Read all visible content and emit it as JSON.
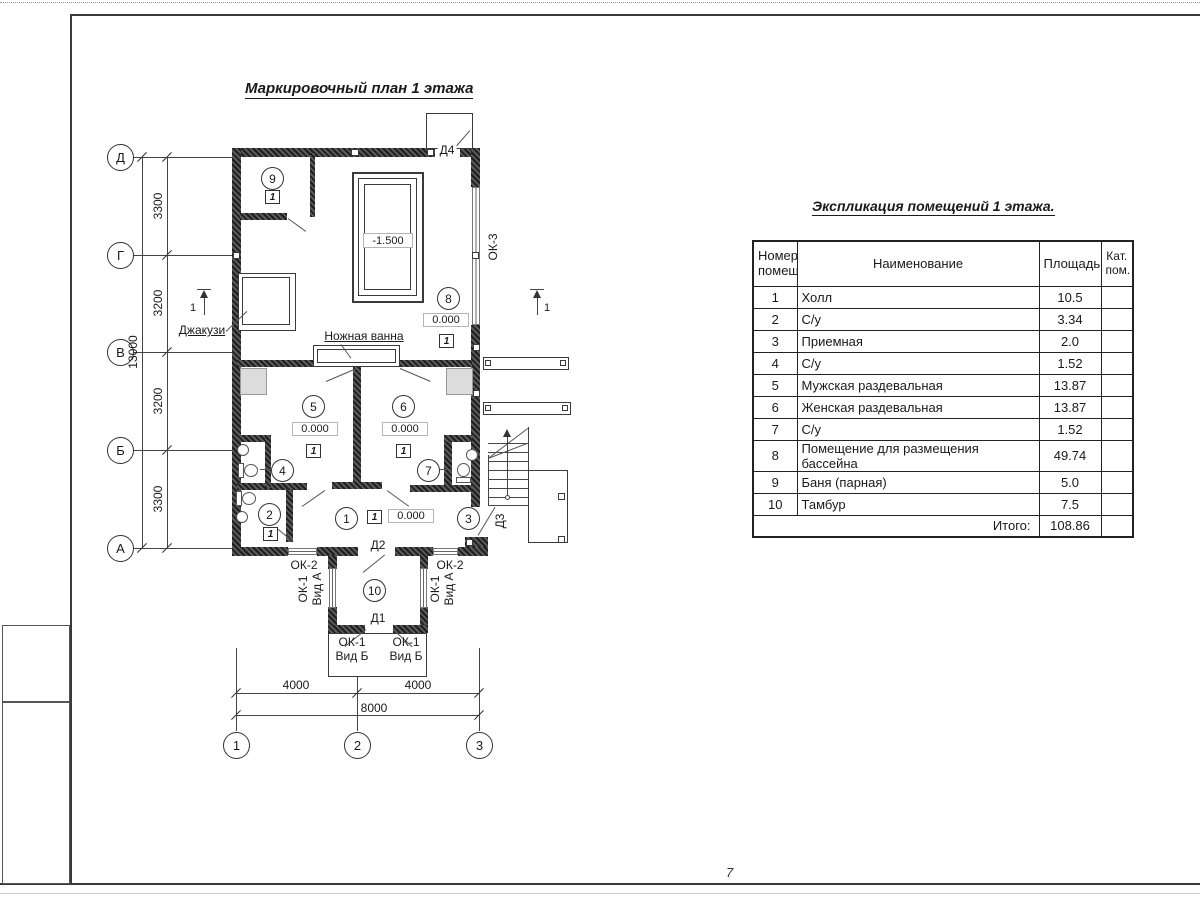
{
  "plan_title": "Маркировочный план 1 этажа",
  "table": {
    "title": "Экспликация помещений 1 этажа.",
    "col_num": "Номер\nпомещ.",
    "col_name": "Наименование",
    "col_area": "Площадь",
    "col_cat": "Кат.\nпом.",
    "rows": [
      {
        "num": "1",
        "name": "Холл",
        "area": "10.5"
      },
      {
        "num": "2",
        "name": "С/у",
        "area": "3.34"
      },
      {
        "num": "3",
        "name": "Приемная",
        "area": "2.0"
      },
      {
        "num": "4",
        "name": "С/у",
        "area": "1.52"
      },
      {
        "num": "5",
        "name": "Мужская раздевальная",
        "area": "13.87"
      },
      {
        "num": "6",
        "name": "Женская раздевальная",
        "area": "13.87"
      },
      {
        "num": "7",
        "name": "С/у",
        "area": "1.52"
      },
      {
        "num": "8",
        "name": "Помещение для размещения бассейна",
        "area": "49.74"
      },
      {
        "num": "9",
        "name": "Баня (парная)",
        "area": "5.0"
      },
      {
        "num": "10",
        "name": "Тамбур",
        "area": "7.5"
      }
    ],
    "total_label": "Итого:",
    "total_value": "108.86"
  },
  "row_axes": [
    "Д",
    "Г",
    "В",
    "Б",
    "А"
  ],
  "col_axes": [
    "1",
    "2",
    "3"
  ],
  "left_dims": [
    "3300",
    "3200",
    "3200",
    "3300"
  ],
  "left_total_dim": "13000",
  "bottom_dims": [
    "4000",
    "4000"
  ],
  "bottom_total_dim": "8000",
  "room_numbers": [
    "1",
    "2",
    "3",
    "4",
    "5",
    "6",
    "7",
    "8",
    "9",
    "10"
  ],
  "marks": {
    "floor_type": "1",
    "elev_zero": "0.000",
    "elev_pool": "-1.500",
    "section": "1"
  },
  "labels": {
    "jacuzzi": "Джакузи",
    "foot_bath": "Ножная ванна",
    "ok1_vid_a": "ОК-1\nВид А",
    "ok1_vid_b": "ОК-1\nВид Б",
    "ok2": "ОК-2",
    "ok3": "ОК-3",
    "d1": "Д1",
    "d2": "Д2",
    "d3": "Д3",
    "d4": "Д4"
  },
  "annotations": {
    "page_note": "7"
  }
}
